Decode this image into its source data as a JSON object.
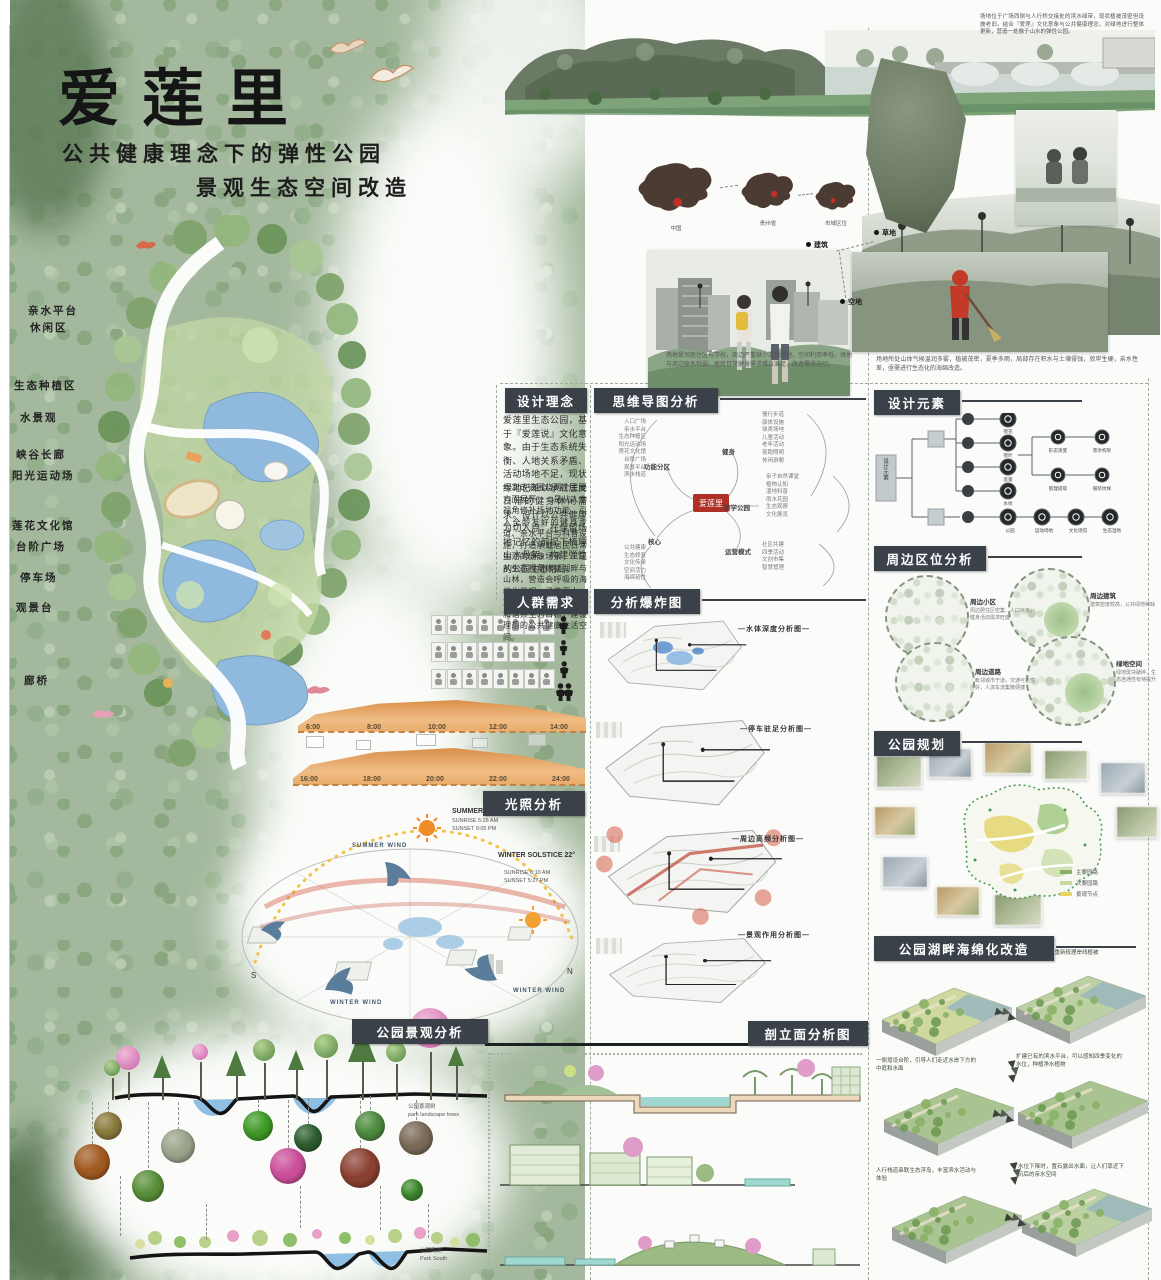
{
  "poster": {
    "title": "爱莲里",
    "subtitle_line1": "公共健康理念下的弹性公园",
    "subtitle_line2": "景观生态空间改造"
  },
  "intro_note": "场地位于广场西侧与人行桥交接处的滨水绿带，现状植被茂密但设施老旧。结合『爱莲』文化意象与公共健康理念，对绿地进行整体更新，营造一处融于山水的弹性公园。",
  "context": {
    "map_captions": [
      "中国",
      "贵州省",
      "市域区位"
    ],
    "site_tags": [
      "建筑",
      "草地",
      "空地"
    ],
    "caption_left": "场地紧邻居住区与学校，周边严重缺少活动场地，空间利用率低，场地与周边联系较弱，居民日常健身需求难以满足，改造需求迫切。",
    "caption_right": "场地所处山体气候温润多雾，植被茂密，夏季多雨，局部存在积水与土壤侵蚀，驳岸生硬，亲水性差，亟需进行生态化的海绵改造。"
  },
  "site_plan": {
    "labels": [
      "亲水平台",
      "休闲区",
      "生态种植区",
      "水景观",
      "峡谷长廊",
      "阳光运动场",
      "莲花文化馆",
      "台阶广场",
      "停车场",
      "观景台",
      "廊桥"
    ]
  },
  "design_concept": {
    "title": "设计理念",
    "para1": "爱莲里生态公园，基于『爱莲说』文化意象。由于生态系统失衡、人地关系矛盾、活动场地不足，现状绿地已难以承载居民日常的健身休闲需求。设计以公共健康为切入点，在保留场地记忆的前提下梳理山水骨架，构建弹性的公园生态格局。",
    "para2": "本次改造围绕两个主要方面展开：一是从人本视角修补场地功能，引入全龄友好的健身步道、亲水平台与科普设施，打造承载居民日常生活的健康场景；二是从生态视角修复湖畔与山林，营造会呼吸的海绵化景观，涵养雨水、净化水体，以人与自然和谐共生为目标，建设理想的公共健康生活空间。"
  },
  "mind_map": {
    "title": "思维导图分析",
    "center": "爱莲里",
    "branches": [
      {
        "label": "功能分区",
        "items": [
          "入口广场",
          "亲水平台",
          "生态种植区",
          "阳光运动场",
          "莲花文化馆",
          "台阶广场",
          "观景平台",
          "滨水栈道"
        ]
      },
      {
        "label": "核心",
        "items": [
          "公共健康",
          "生态修复",
          "文化传承",
          "空间活力",
          "海绵韧性"
        ]
      },
      {
        "label": "健身",
        "items": [
          "慢行步道",
          "康体设施",
          "球类场地",
          "儿童活动",
          "老年活动",
          "夜跑照明",
          "休闲游憩"
        ]
      },
      {
        "label": "研学公园",
        "items": [
          "亲子自然课堂",
          "植物认知",
          "湿地科普",
          "雨水花园",
          "生态观察",
          "文化展览"
        ]
      },
      {
        "label": "运营模式",
        "items": [
          "社区共建",
          "四季活动",
          "文创市集",
          "智慧管理"
        ]
      }
    ]
  },
  "crowd_needs": {
    "title": "人群需求",
    "timeline_am": [
      "6:00",
      "8:00",
      "10:00",
      "12:00",
      "14:00"
    ],
    "timeline_pm": [
      "16:00",
      "18:00",
      "20:00",
      "22:00",
      "24:00"
    ]
  },
  "explosion_analysis": {
    "title": "分析爆炸图",
    "diagrams": [
      "—水体深度分析图—",
      "—停车驻足分析图—",
      "—周边高频分析图—",
      "—景观作用分析图—"
    ]
  },
  "sunlight": {
    "title": "光照分析",
    "summer_label": "SUMMER SOLSTICE 68°",
    "summer_sunrise": "SUNRISE 5:28 AM",
    "summer_sunset": "SUNSET 9:05 PM",
    "winter_label": "WINTER SOLSTICE 22°",
    "winter_sunrise": "SUNRISE 8:10 AM",
    "winter_sunset": "SUNSET 5:27 PM",
    "summer_wind": "SUMMER WIND",
    "winter_wind_left": "WINTER WIND",
    "winter_wind_right": "WINTER WIND",
    "compass_s": "S",
    "compass_n": "N"
  },
  "design_elements": {
    "title": "设计元素",
    "root": "设计元素",
    "nature_leaves": [
      "荷花",
      "荷叶",
      "莲蓬",
      "水纹"
    ],
    "derive_leaves": [
      "形态演变",
      "肌理提取",
      "景亭构架",
      "铺装纹样"
    ],
    "site_leaves": [
      "公园",
      "运动场地",
      "文化场馆",
      "生态湿地"
    ]
  },
  "location_analysis": {
    "title": "周边区位分析",
    "items": [
      {
        "label": "周边小区",
        "desc": "周边居住区密集、人口众多，健身活动需求旺盛"
      },
      {
        "label": "周边建筑",
        "desc": "建筑密度较高，公共绿地稀缺"
      },
      {
        "label": "周边道路",
        "desc": "毗邻城市干道，交通可达性好，人流车流集散便捷"
      },
      {
        "label": "绿地空间",
        "desc": "绿地斑块破碎，生态连通性有待提升"
      }
    ]
  },
  "park_planning": {
    "title": "公园规划",
    "legend": [
      "主要园路",
      "次要园路",
      "景观节点"
    ]
  },
  "landscape_analysis": {
    "title": "公园景观分析",
    "label_trees_cn": "公园景观树",
    "label_trees_en": "park landscape trees",
    "label_south_cn": "公园南侧",
    "label_south_en": "Park South"
  },
  "section_elevation": {
    "title": "剖立面分析图"
  },
  "sponge_retrofit": {
    "title": "公园湖畔海绵化改造",
    "notes": [
      "硬质驳岸生硬单调，亲水性差",
      "因为雨水冲刷，重新梳理岸线植被",
      "一侧增设台阶，引导人们走近水岸下方的中庭和水面",
      "扩建已有的滨水平台，可以感知四季变化的水位，种植净水植物",
      "人行栈道串联生态浮岛，丰富滨水活动与体验",
      "水位下降时，置石露出水面，让人们靠近下沉后的亲水空间"
    ]
  }
}
